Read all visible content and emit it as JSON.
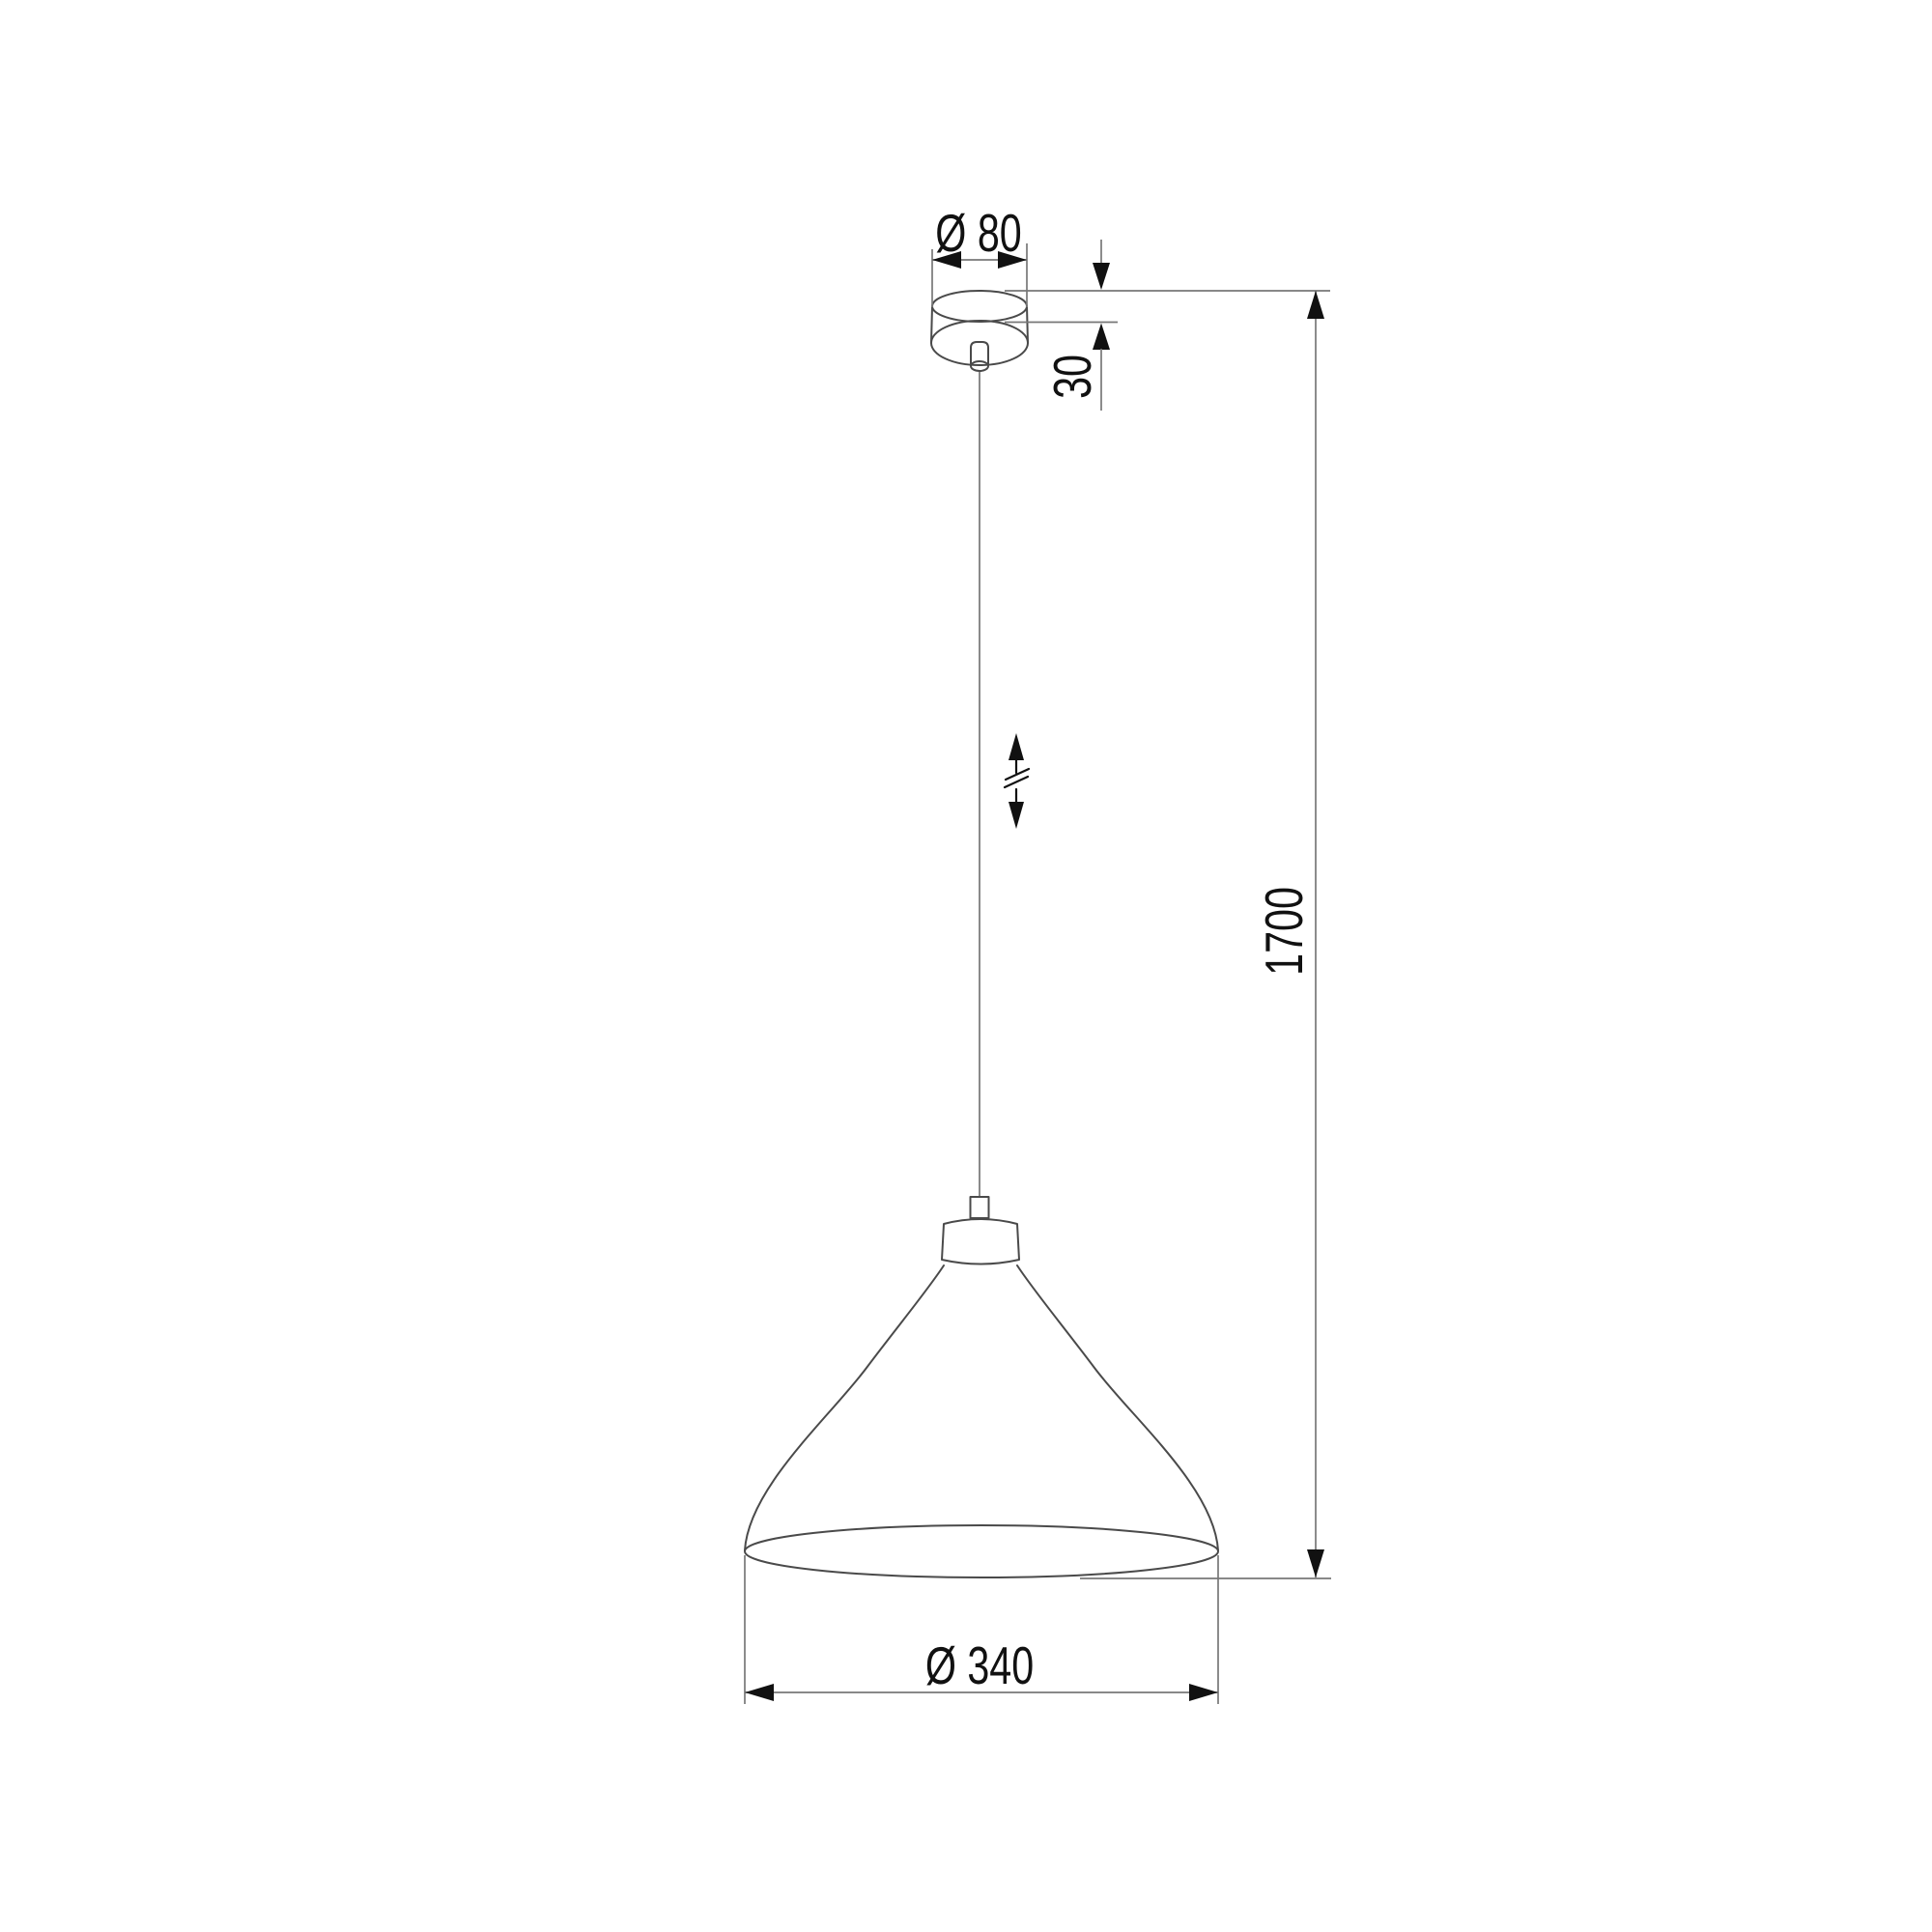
{
  "drawing": {
    "kind": "pendant-lamp-dimension-drawing",
    "labels": {
      "canopy_diameter": "Ø 80",
      "canopy_height": "30",
      "suspension_height": "1700",
      "shade_diameter": "Ø 340"
    },
    "colors": {
      "background": "#ffffff",
      "outline": "#4a4a4a",
      "dimension_line": "#777777",
      "dimension_text": "#111111",
      "cable": "#8a8a8a"
    }
  }
}
